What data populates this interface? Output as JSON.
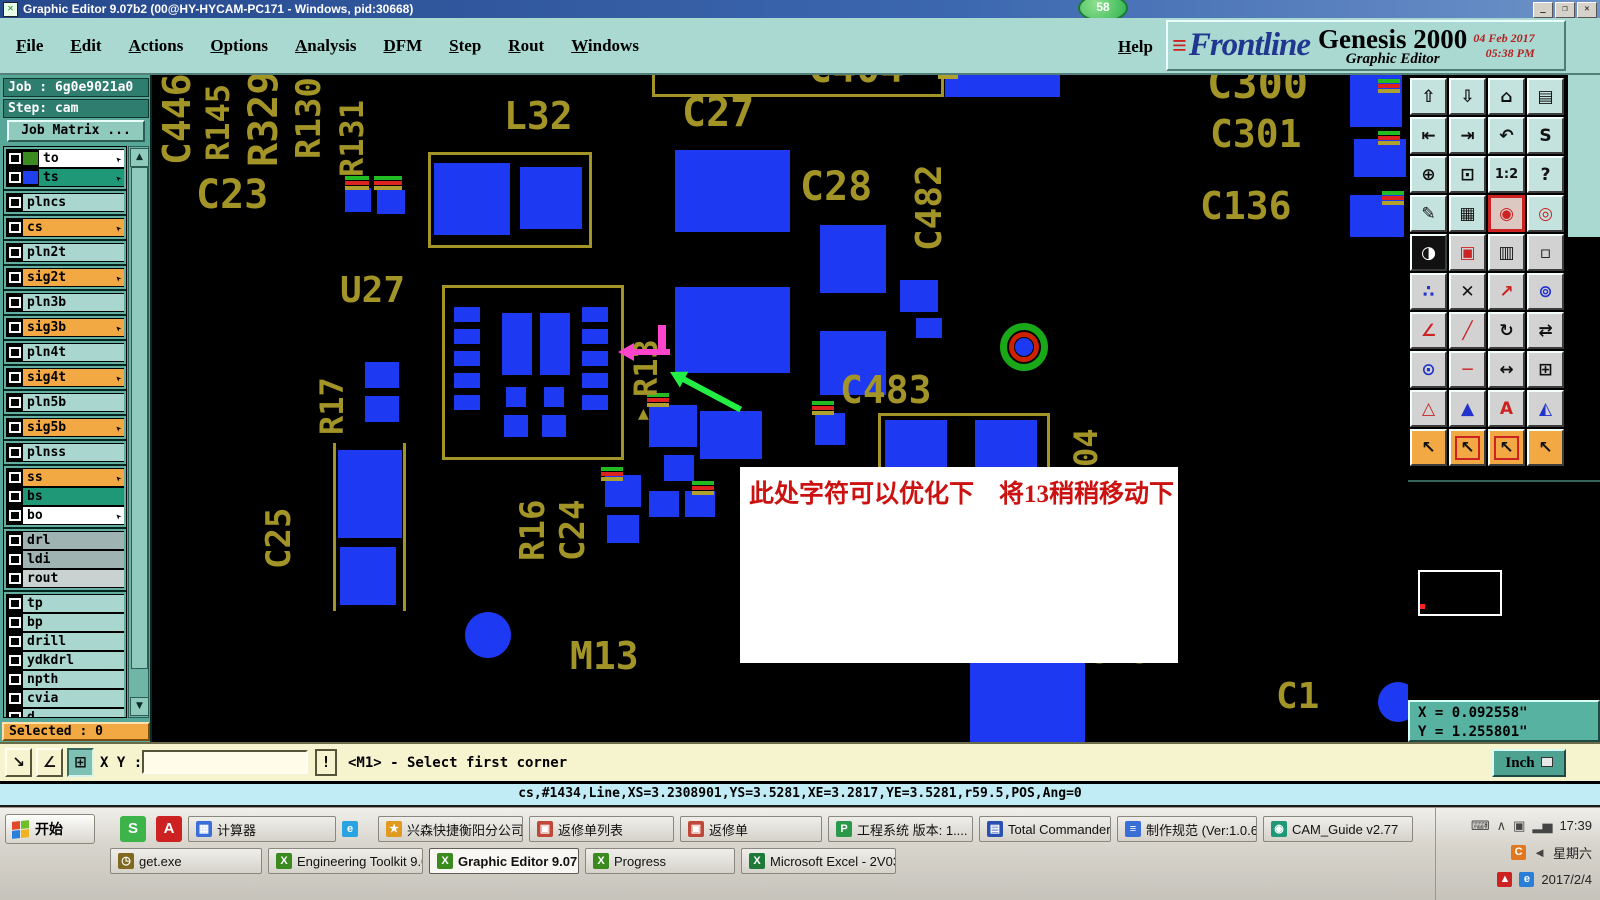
{
  "title_bar": {
    "title": "Graphic Editor 9.07b2 (00@HY-HYCAM-PC171 - Windows, pid:30668)",
    "badge": "58",
    "buttons": {
      "minimize": "_",
      "maximize": "❐",
      "close": "✕"
    }
  },
  "menu_bar": {
    "items": [
      "File",
      "Edit",
      "Actions",
      "Options",
      "Analysis",
      "DFM",
      "Step",
      "Rout",
      "Windows"
    ],
    "help": "Help"
  },
  "brand": {
    "logo": "Frontline",
    "speed_lines": "≡",
    "product": "Genesis 2000",
    "subtitle": "Graphic Editor",
    "date": "04 Feb 2017",
    "time": "05:38 PM"
  },
  "sidebar": {
    "job_label": "Job : 6g0e9021a0",
    "step_label": "Step: cam",
    "job_matrix_label": "Job Matrix ...",
    "selected_label": "Selected : 0",
    "layers": [
      {
        "name": "to",
        "bg": "wh",
        "swatch": "#3a8a20",
        "arrow": true,
        "g": 1
      },
      {
        "name": "ts",
        "bg": "tg",
        "swatch": "#2040ee",
        "arrow": true,
        "g": 1
      },
      {
        "name": "plncs",
        "bg": "lt",
        "g": 2
      },
      {
        "name": "cs",
        "bg": "or",
        "arrow": true,
        "g": 3
      },
      {
        "name": "pln2t",
        "bg": "lt",
        "g": 4
      },
      {
        "name": "sig2t",
        "bg": "or",
        "arrow": true,
        "g": 5
      },
      {
        "name": "pln3b",
        "bg": "lt",
        "g": 6
      },
      {
        "name": "sig3b",
        "bg": "or",
        "arrow": true,
        "g": 7
      },
      {
        "name": "pln4t",
        "bg": "lt",
        "g": 8
      },
      {
        "name": "sig4t",
        "bg": "or",
        "arrow": true,
        "g": 9
      },
      {
        "name": "pln5b",
        "bg": "lt",
        "g": 10
      },
      {
        "name": "sig5b",
        "bg": "or",
        "arrow": true,
        "g": 11
      },
      {
        "name": "plnss",
        "bg": "lt",
        "g": 12
      },
      {
        "name": "ss",
        "bg": "or",
        "arrow": true,
        "g": 13
      },
      {
        "name": "bs",
        "bg": "tg",
        "g": 13
      },
      {
        "name": "bo",
        "bg": "wh",
        "arrow": true,
        "g": 13
      },
      {
        "name": "drl",
        "bg": "gy",
        "g": 14
      },
      {
        "name": "ldi",
        "bg": "gy",
        "g": 14
      },
      {
        "name": "rout",
        "bg": "lg",
        "g": 14
      },
      {
        "name": "tp",
        "bg": "lt",
        "g": 15
      },
      {
        "name": "bp",
        "bg": "lt",
        "g": 15
      },
      {
        "name": "drill",
        "bg": "lt",
        "g": 15
      },
      {
        "name": "ydkdrl",
        "bg": "lt",
        "g": 15
      },
      {
        "name": "npth",
        "bg": "lt",
        "g": 15
      },
      {
        "name": "cvia",
        "bg": "lt",
        "g": 15
      },
      {
        "name": "d",
        "bg": "lt",
        "g": 15
      },
      {
        "name": "to.d",
        "bg": "lt",
        "swatch": "#ee1111",
        "arrow": true,
        "extra": true,
        "selected": true,
        "g": 16
      },
      {
        "name": "ts.d",
        "bg": "lt",
        "arrow": true,
        "g": 16
      },
      {
        "name": "cs.d",
        "bg": "lt",
        "arrow": true,
        "g": 16
      },
      {
        "name": "sig2t.d",
        "bg": "lt",
        "arrow": true,
        "g": 16
      },
      {
        "name": "sig3b.d",
        "bg": "lt",
        "arrow": true,
        "g": 16
      },
      {
        "name": "sig4t.d",
        "bg": "lt",
        "arrow": true,
        "g": 16
      }
    ]
  },
  "canvas": {
    "labels": [
      {
        "t": "C446",
        "x": 6,
        "y": -10,
        "v": 1,
        "s": 38,
        "l": 100
      },
      {
        "t": "R145",
        "x": 50,
        "y": -2,
        "v": 1,
        "s": 32,
        "l": 88
      },
      {
        "t": "R329",
        "x": 92,
        "y": -8,
        "v": 1,
        "s": 40,
        "l": 100
      },
      {
        "t": "C23",
        "x": 44,
        "y": 100,
        "s": 40
      },
      {
        "t": "R130",
        "x": 140,
        "y": -8,
        "v": 1,
        "s": 34,
        "l": 92
      },
      {
        "t": "R131",
        "x": 184,
        "y": 14,
        "v": 1,
        "s": 32,
        "l": 88
      },
      {
        "t": "L32",
        "x": 352,
        "y": 22,
        "s": 38
      },
      {
        "t": "C27",
        "x": 530,
        "y": 18,
        "s": 40
      },
      {
        "t": "C404",
        "x": 656,
        "y": -26,
        "s": 40
      },
      {
        "t": "C28",
        "x": 648,
        "y": 92,
        "s": 40
      },
      {
        "t": "C482",
        "x": 760,
        "y": 58,
        "v": 1,
        "s": 36,
        "l": 118
      },
      {
        "t": "C300",
        "x": 1055,
        "y": -12,
        "s": 42
      },
      {
        "t": "C301",
        "x": 1058,
        "y": 40,
        "s": 38
      },
      {
        "t": "C136",
        "x": 1048,
        "y": 112,
        "s": 38
      },
      {
        "t": "U27",
        "x": 188,
        "y": 198,
        "s": 36
      },
      {
        "t": "R13",
        "x": 478,
        "y": 232,
        "v": 1,
        "s": 32,
        "l": 90
      },
      {
        "t": "▲",
        "x": 486,
        "y": 330,
        "s": 18
      },
      {
        "t": "C483",
        "x": 688,
        "y": 296,
        "s": 38
      },
      {
        "t": "R17",
        "x": 164,
        "y": 284,
        "v": 1,
        "s": 32,
        "l": 76
      },
      {
        "t": "C25",
        "x": 110,
        "y": 416,
        "v": 1,
        "s": 34,
        "l": 78
      },
      {
        "t": "R16",
        "x": 364,
        "y": 408,
        "v": 1,
        "s": 34,
        "l": 78
      },
      {
        "t": "C24",
        "x": 404,
        "y": 408,
        "v": 1,
        "s": 34,
        "l": 78
      },
      {
        "t": "M13",
        "x": 418,
        "y": 562,
        "s": 38
      },
      {
        "t": "04",
        "x": 918,
        "y": 336,
        "v": 1,
        "s": 32,
        "l": 56
      },
      {
        "t": "3.52",
        "x": 938,
        "y": 560,
        "s": 34
      },
      {
        "t": "C1",
        "x": 1124,
        "y": 604,
        "s": 36
      }
    ],
    "outlines": [
      {
        "x": 276,
        "y": 77,
        "w": 164,
        "h": 96
      },
      {
        "x": 290,
        "y": 210,
        "w": 182,
        "h": 175
      },
      {
        "x": 500,
        "y": -22,
        "w": 292,
        "h": 44
      },
      {
        "x": 726,
        "y": 338,
        "w": 172,
        "h": 60
      }
    ],
    "olines": [
      {
        "x": 181,
        "y": 368,
        "w": 3,
        "h": 168
      },
      {
        "x": 251,
        "y": 368,
        "w": 3,
        "h": 168
      }
    ],
    "pads": [
      {
        "x": 282,
        "y": 88,
        "w": 76,
        "h": 72
      },
      {
        "x": 368,
        "y": 92,
        "w": 62,
        "h": 62
      },
      {
        "x": 193,
        "y": 113,
        "w": 26,
        "h": 24
      },
      {
        "x": 225,
        "y": 115,
        "w": 28,
        "h": 24
      },
      {
        "x": 523,
        "y": 75,
        "w": 115,
        "h": 82
      },
      {
        "x": 523,
        "y": 212,
        "w": 115,
        "h": 86
      },
      {
        "x": 668,
        "y": 150,
        "w": 66,
        "h": 68
      },
      {
        "x": 668,
        "y": 256,
        "w": 66,
        "h": 64
      },
      {
        "x": 748,
        "y": 205,
        "w": 38,
        "h": 32
      },
      {
        "x": 764,
        "y": 243,
        "w": 26,
        "h": 20
      },
      {
        "x": 793,
        "y": -12,
        "w": 115,
        "h": 34
      },
      {
        "x": 302,
        "y": 232,
        "w": 26,
        "h": 15
      },
      {
        "x": 302,
        "y": 254,
        "w": 26,
        "h": 15
      },
      {
        "x": 302,
        "y": 276,
        "w": 26,
        "h": 15
      },
      {
        "x": 302,
        "y": 298,
        "w": 26,
        "h": 15
      },
      {
        "x": 302,
        "y": 320,
        "w": 26,
        "h": 15
      },
      {
        "x": 430,
        "y": 232,
        "w": 26,
        "h": 15
      },
      {
        "x": 430,
        "y": 254,
        "w": 26,
        "h": 15
      },
      {
        "x": 430,
        "y": 276,
        "w": 26,
        "h": 15
      },
      {
        "x": 430,
        "y": 298,
        "w": 26,
        "h": 15
      },
      {
        "x": 430,
        "y": 320,
        "w": 26,
        "h": 15
      },
      {
        "x": 350,
        "y": 238,
        "w": 30,
        "h": 62
      },
      {
        "x": 388,
        "y": 238,
        "w": 30,
        "h": 62
      },
      {
        "x": 354,
        "y": 312,
        "w": 20,
        "h": 20
      },
      {
        "x": 392,
        "y": 312,
        "w": 20,
        "h": 20
      },
      {
        "x": 352,
        "y": 340,
        "w": 24,
        "h": 22
      },
      {
        "x": 390,
        "y": 340,
        "w": 24,
        "h": 22
      },
      {
        "x": 213,
        "y": 287,
        "w": 34,
        "h": 26
      },
      {
        "x": 213,
        "y": 321,
        "w": 34,
        "h": 26
      },
      {
        "x": 186,
        "y": 375,
        "w": 64,
        "h": 88
      },
      {
        "x": 188,
        "y": 472,
        "w": 56,
        "h": 58
      },
      {
        "x": 313,
        "y": 537,
        "w": 46,
        "h": 46,
        "r": 1
      },
      {
        "x": 497,
        "y": 330,
        "w": 48,
        "h": 42
      },
      {
        "x": 512,
        "y": 380,
        "w": 30,
        "h": 26
      },
      {
        "x": 453,
        "y": 400,
        "w": 36,
        "h": 32
      },
      {
        "x": 497,
        "y": 416,
        "w": 30,
        "h": 26
      },
      {
        "x": 533,
        "y": 416,
        "w": 30,
        "h": 26
      },
      {
        "x": 455,
        "y": 440,
        "w": 32,
        "h": 28
      },
      {
        "x": 548,
        "y": 336,
        "w": 62,
        "h": 48
      },
      {
        "x": 663,
        "y": 338,
        "w": 30,
        "h": 32
      },
      {
        "x": 733,
        "y": 345,
        "w": 62,
        "h": 48
      },
      {
        "x": 823,
        "y": 345,
        "w": 62,
        "h": 48
      },
      {
        "x": 818,
        "y": 585,
        "w": 115,
        "h": 82
      },
      {
        "x": 1226,
        "y": 607,
        "w": 40,
        "h": 40,
        "r": 1
      },
      {
        "x": 1198,
        "y": 0,
        "w": 52,
        "h": 52
      },
      {
        "x": 1202,
        "y": 64,
        "w": 52,
        "h": 38
      },
      {
        "x": 1198,
        "y": 120,
        "w": 54,
        "h": 42
      }
    ],
    "ticks": [
      {
        "x": 222,
        "y": 101,
        "w": 28
      },
      {
        "x": 193,
        "y": 101,
        "w": 24
      },
      {
        "x": 786,
        "y": -10,
        "w": 20
      },
      {
        "x": 1226,
        "y": 4,
        "w": 22
      },
      {
        "x": 1226,
        "y": 56,
        "w": 22
      },
      {
        "x": 1230,
        "y": 116,
        "w": 22
      },
      {
        "x": 495,
        "y": 318,
        "w": 22
      },
      {
        "x": 540,
        "y": 406,
        "w": 22
      },
      {
        "x": 660,
        "y": 326,
        "w": 22
      },
      {
        "x": 449,
        "y": 392,
        "w": 22
      }
    ],
    "tick_colors": [
      "#22bb22",
      "#dd2222",
      "#b0a030"
    ],
    "vias": [
      {
        "x": 848,
        "y": 248,
        "d": 48
      }
    ],
    "marks": [
      {
        "x": 506,
        "y": 250,
        "w": 8,
        "h": 24,
        "c": "#ff44cc"
      }
    ],
    "arrows": [
      {
        "name": "move-hint-arrow",
        "color": "#ff44cc",
        "x": 466,
        "y": 274,
        "len": 52,
        "angle": 0
      },
      {
        "name": "pointer-arrow",
        "color": "#22ee44",
        "x": 518,
        "y": 294,
        "len": 80,
        "angle": 28
      }
    ],
    "annotation": {
      "x": 588,
      "y": 392,
      "w": 438,
      "h": 196,
      "text": "此处字符可以优化下　将13稍稍移动下"
    }
  },
  "toolbar": {
    "buttons": [
      {
        "n": "view-up",
        "g": "⇧"
      },
      {
        "n": "view-down",
        "g": "⇩"
      },
      {
        "n": "home-view",
        "g": "⌂"
      },
      {
        "n": "tile-windows",
        "g": "▤"
      },
      {
        "n": "view-left",
        "g": "⇤"
      },
      {
        "n": "view-right",
        "g": "⇥"
      },
      {
        "n": "previous-view",
        "g": "↶"
      },
      {
        "n": "swap-view",
        "g": "S"
      },
      {
        "n": "zoom-fit-all",
        "g": "⊕"
      },
      {
        "n": "zoom-center",
        "g": "⊡"
      },
      {
        "n": "zoom-ratio-1-2",
        "g": "1:2"
      },
      {
        "n": "help-mode",
        "g": "?"
      },
      {
        "n": "setup-tools",
        "g": "✎"
      },
      {
        "n": "grid-toggle",
        "g": "▦"
      },
      {
        "n": "net-highlight",
        "g": "◉",
        "sel": 1,
        "fg": "#cc2222"
      },
      {
        "n": "net-view",
        "g": "◎",
        "fg": "#cc2222"
      },
      {
        "n": "bw-display",
        "g": "◑",
        "dark": 1
      },
      {
        "n": "zoom-area",
        "g": "▣",
        "fg": "#cc2222"
      },
      {
        "n": "measure-ruler",
        "g": "▥"
      },
      {
        "n": "select-area",
        "g": "▫"
      },
      {
        "n": "connectivity",
        "g": "∴",
        "fg": "#2233cc"
      },
      {
        "n": "delete-mode",
        "g": "✕"
      },
      {
        "n": "move-mode",
        "g": "↗",
        "fg": "#cc2222"
      },
      {
        "n": "copy-mode",
        "g": "⊚",
        "fg": "#2233cc"
      },
      {
        "n": "angle-measure",
        "g": "∠",
        "fg": "#cc2222"
      },
      {
        "n": "slope-measure",
        "g": "╱",
        "fg": "#cc2222"
      },
      {
        "n": "rotate-mode",
        "g": "↻"
      },
      {
        "n": "mirror-mode",
        "g": "⇄"
      },
      {
        "n": "pad-swap",
        "g": "⊙",
        "fg": "#2233cc"
      },
      {
        "n": "line-mode",
        "g": "─",
        "fg": "#cc2222"
      },
      {
        "n": "measure-distance",
        "g": "↔"
      },
      {
        "n": "reference-box",
        "g": "⊞"
      },
      {
        "n": "triangle-open",
        "g": "△",
        "fg": "#cc2222"
      },
      {
        "n": "triangle-up",
        "g": "▲",
        "fg": "#2233cc"
      },
      {
        "n": "triangle-a",
        "g": "A",
        "fg": "#cc2222"
      },
      {
        "n": "triangle-side",
        "g": "◭",
        "fg": "#2233cc"
      },
      {
        "n": "select-single",
        "g": "↖"
      },
      {
        "n": "select-frame",
        "g": "↖",
        "box": 1
      },
      {
        "n": "select-polygon",
        "g": "↖",
        "box": 1
      },
      {
        "n": "select-net",
        "g": "↖"
      }
    ]
  },
  "coords": {
    "x": "X = 0.092558\"",
    "y": "Y = 1.255801\""
  },
  "command_bar": {
    "xy_label": "X Y :",
    "input_value": "",
    "bang": "!",
    "prompt": "<M1> - Select first corner",
    "unit": "Inch",
    "tools": [
      {
        "n": "zoom-window-button",
        "g": "↘"
      },
      {
        "n": "measure-angle-button",
        "g": "∠"
      },
      {
        "n": "grid-snap-button",
        "g": "⊞",
        "pressed": 1
      }
    ]
  },
  "status_line": "cs,#1434,Line,XS=3.2308901,YS=3.5281,XE=3.2817,YE=3.5281,r59.5,POS,Ang=0",
  "taskbar": {
    "start_label": "开始",
    "quick": [
      {
        "id": "quick-launch-s",
        "g": "S",
        "c": "#3cb44a",
        "x": 120
      },
      {
        "id": "quick-launch-pdf",
        "g": "A",
        "c": "#cc2222",
        "x": 156
      }
    ],
    "row1": [
      {
        "id": "calculator",
        "label": "计算器",
        "ic": "▦",
        "c": "#3a6fd8",
        "w": 148
      },
      {
        "id": "ie-icon",
        "label": "",
        "ic": "e",
        "c": "#2aa4e0",
        "standalone": 1,
        "w": 30
      },
      {
        "id": "xingsen",
        "label": "兴森快捷衡阳分公司...",
        "ic": "★",
        "c": "#e09a20",
        "w": 145
      },
      {
        "id": "fanxiudan-list",
        "label": "返修单列表",
        "ic": "▣",
        "c": "#c04838",
        "w": 145
      },
      {
        "id": "fanxiudan",
        "label": "返修单",
        "ic": "▣",
        "c": "#c04838",
        "w": 142
      },
      {
        "id": "gongcheng-xitong",
        "label": "工程系统  版本: 1....",
        "ic": "P",
        "c": "#2a9a4a",
        "w": 145
      },
      {
        "id": "total-commander",
        "label": "Total Commander 7.0 ...",
        "ic": "▤",
        "c": "#2a50b0",
        "w": 132
      },
      {
        "id": "zhizuo-guifan",
        "label": "制作规范 (Ver:1.0.6)",
        "ic": "≡",
        "c": "#3a6fd8",
        "w": 140
      },
      {
        "id": "cam-guide",
        "label": "CAM_Guide v2.77",
        "ic": "◉",
        "c": "#1f9878",
        "w": 150
      }
    ],
    "row2": [
      {
        "id": "get-exe",
        "label": "get.exe",
        "ic": "◷",
        "c": "#806820",
        "w": 152
      },
      {
        "id": "engineering-toolkit",
        "label": "Engineering Toolkit 9.07...",
        "ic": "X",
        "c": "#3a8a20",
        "w": 155
      },
      {
        "id": "graphic-editor",
        "label": "Graphic Editor 9.07b2 ...",
        "ic": "X",
        "c": "#3a8a20",
        "active": 1,
        "w": 150
      },
      {
        "id": "progress",
        "label": "Progress",
        "ic": "X",
        "c": "#3a8a20",
        "w": 150
      },
      {
        "id": "excel",
        "label": "Microsoft Excel - 2V030K...",
        "ic": "X",
        "c": "#1f7a3a",
        "w": 155
      }
    ],
    "tray": {
      "time": "17:39",
      "day": "星期六",
      "date": "2017/2/4",
      "icons_row1": [
        "⌨",
        "∧",
        "▣",
        "▂▅"
      ],
      "icons_row2": [
        "C",
        "◄"
      ],
      "icons_row3": [
        "▲",
        "e"
      ]
    }
  }
}
